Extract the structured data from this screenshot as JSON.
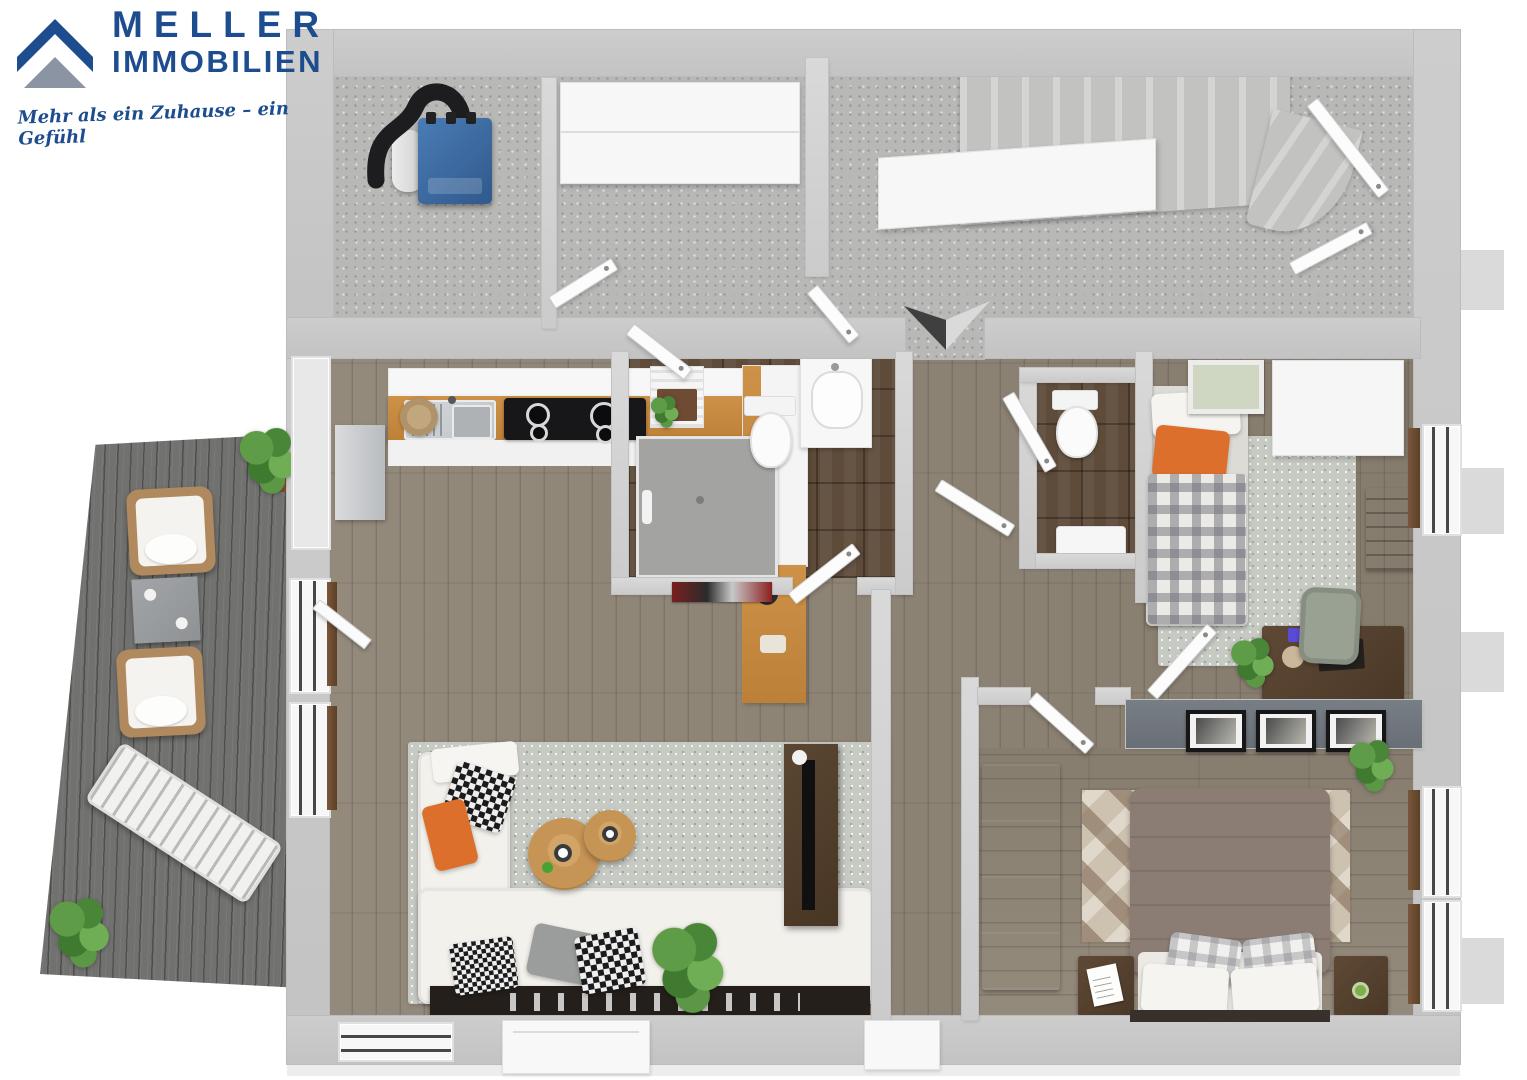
{
  "branding": {
    "company_line1": "MELLER",
    "company_line2": "IMMOBILIEN",
    "tagline": "Mehr als ein Zuhause – ein Gefühl",
    "logo_icon": "house-roof-chevrons-icon"
  },
  "palette": {
    "logo-blue": "#1d4d8f",
    "logo-gray": "#8a94a2",
    "wall-outer": "#c6c6c6",
    "wall-inner": "#d7d7d7",
    "floor-screed": "#b8b8b7",
    "wood-floor": "#8f8577",
    "bath-tile": "#5e4b3a",
    "terrace-deck": "#717170",
    "counter-top": "#c78f45",
    "rug-gray": "#c7c9c3",
    "sofa-white": "#f3f1ec",
    "table-tan": "#c69455",
    "orange-accent": "#dd6f2d",
    "duvet-taupe": "#8b7c74",
    "dark-wood": "#53402e",
    "divider-gray": "#787e85",
    "plant-green": "#4e8f3a",
    "boiler-blue": "#3a6ea8",
    "chair-sage": "#99a193"
  },
  "scene": {
    "type": "3d-floor-plan-top-down-render",
    "compass": "two-tone arrow pointing down (south)",
    "rooms": [
      {
        "name": "boiler-room",
        "floor": "screed",
        "items": [
          "blue boiler",
          "black flue pipe",
          "expansion tank"
        ]
      },
      {
        "name": "storage-room",
        "floor": "screed",
        "items": [
          "white built-in wardrobe"
        ]
      },
      {
        "name": "landing",
        "floor": "screed",
        "items": [
          "staircase",
          "guard wall",
          "entrance door",
          "compass arrow"
        ]
      },
      {
        "name": "kitchen",
        "floor": "wood",
        "items": [
          "sink with drainer",
          "cooktop 4 burners",
          "orange worktop",
          "tall cabinet"
        ]
      },
      {
        "name": "bathroom",
        "floor": "dark-tile",
        "items": [
          "walk-in shower",
          "wall-hung toilet",
          "vanity sink",
          "towel radiator",
          "wall picture"
        ]
      },
      {
        "name": "wc",
        "floor": "dark-tile",
        "items": [
          "toilet",
          "hand basin"
        ]
      },
      {
        "name": "living-room",
        "floor": "wood",
        "items": [
          "white corner sofa",
          "two rattan coffee tables",
          "gray rug",
          "tv sideboard",
          "tv panel",
          "potted plant"
        ]
      },
      {
        "name": "hallway",
        "floor": "wood",
        "items": [
          "open doors"
        ]
      },
      {
        "name": "kids-room",
        "floor": "wood",
        "items": [
          "single bed orange pillow",
          "gingham duvet",
          "white wardrobe",
          "desk",
          "chair",
          "wall shelf",
          "gray rug",
          "plant",
          "picture"
        ]
      },
      {
        "name": "bedroom",
        "floor": "wood",
        "items": [
          "double bed taupe duvet",
          "plaid pillows",
          "geometric rug",
          "two nightstands",
          "wardrobe",
          "three picture frames on divider wall",
          "plant"
        ]
      },
      {
        "name": "terrace",
        "floor": "gray-deck",
        "items": [
          "two wicker armchairs",
          "gray side table",
          "white sun lounger",
          "two potted plants"
        ]
      }
    ]
  }
}
